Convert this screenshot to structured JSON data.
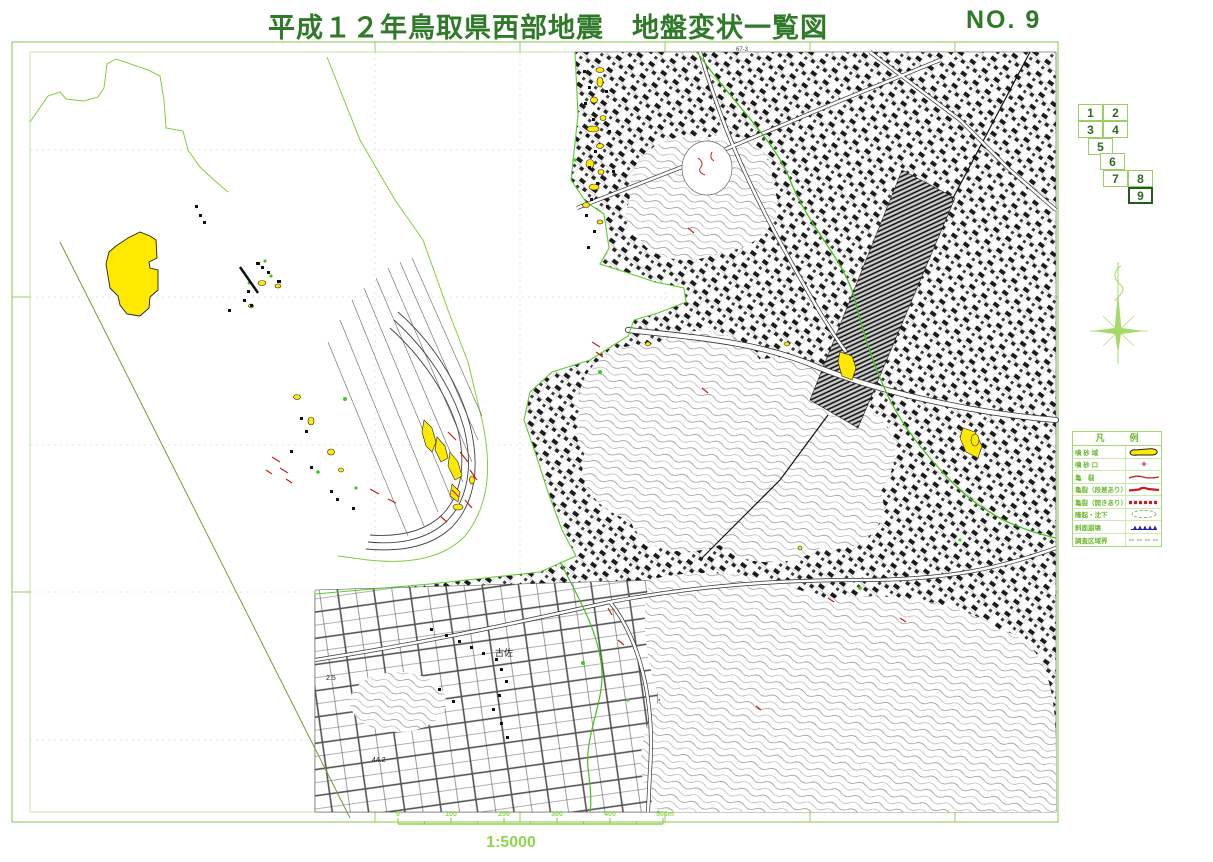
{
  "title": "平成１２年鳥取県西部地震　地盤変状一覧図",
  "sheet_no": "NO. 9",
  "sheet_index": {
    "cells": [
      "1",
      "2",
      "3",
      "4",
      "5",
      "6",
      "7",
      "8",
      "9"
    ],
    "current": "9"
  },
  "legend": {
    "title": "凡　例",
    "rows": [
      {
        "label": "噴 砂 域",
        "symbol": "sand-area"
      },
      {
        "label": "噴 砂 口",
        "symbol": "sand-vent"
      },
      {
        "label": "亀　裂",
        "symbol": "crack"
      },
      {
        "label": "亀裂（段差あり）",
        "symbol": "crack-step"
      },
      {
        "label": "亀裂（開きあり）",
        "symbol": "crack-open"
      },
      {
        "label": "隆起・沈下",
        "symbol": "uplift-subsidence"
      },
      {
        "label": "斜面崩壊",
        "symbol": "slope-failure"
      },
      {
        "label": "調査区域界",
        "symbol": "survey-boundary"
      }
    ]
  },
  "scale_bar": {
    "labels": [
      "0",
      "100",
      "200",
      "300",
      "400",
      "500m"
    ],
    "ratio": "1:5000"
  },
  "map_labels": {
    "grid_label": "67-3",
    "place": "古佐",
    "elevation_1": "44.2",
    "elevation_2": "2.5"
  },
  "colors": {
    "title_green": "#2f7a28",
    "frame_green": "#9ccf63",
    "bright_green": "#46c01c",
    "pale_green": "#85cc3f",
    "scale_green": "#8fd64e",
    "sand_yellow": "#ffe900",
    "crack_red": "#c81e1e",
    "slope_blue": "#2222bb",
    "map_black": "#1a1a1a"
  }
}
